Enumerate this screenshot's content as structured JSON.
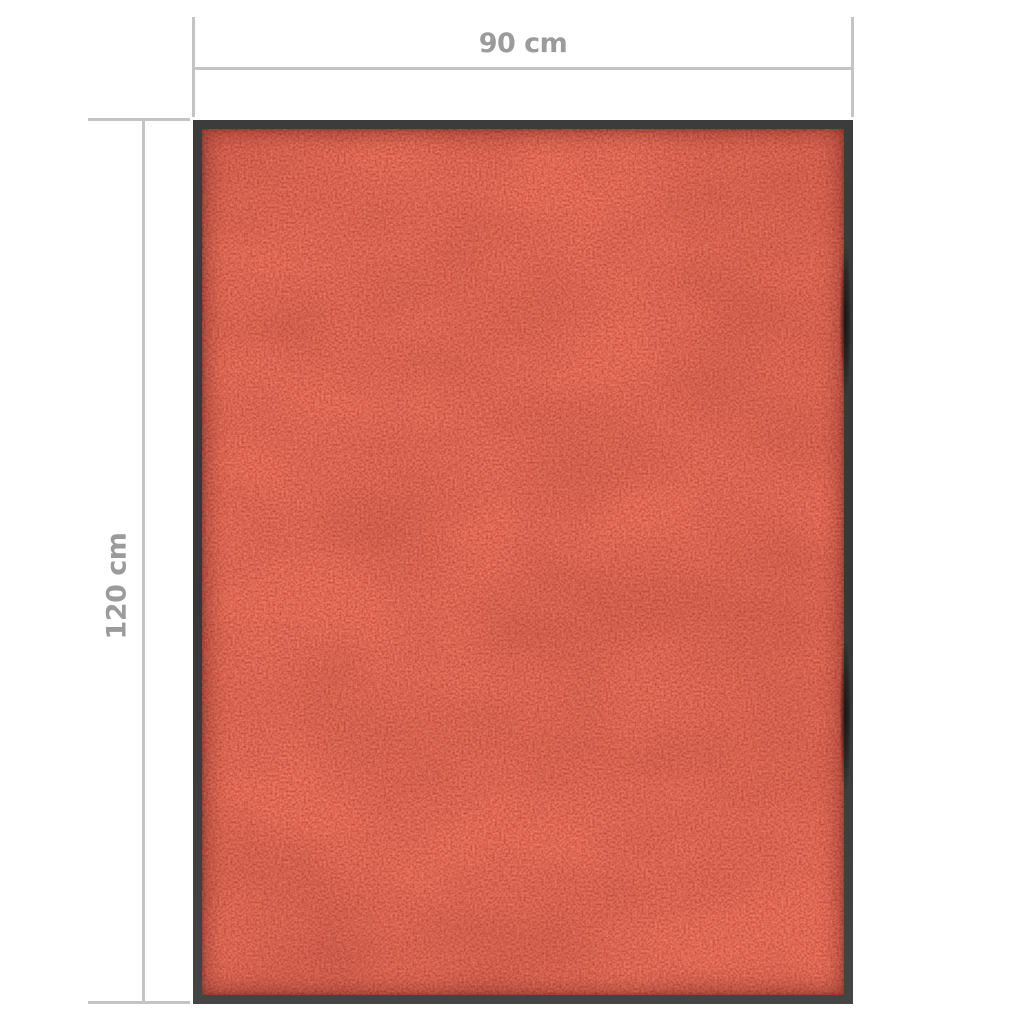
{
  "dimensions": {
    "width_label": "90 cm",
    "height_label": "120 cm"
  },
  "colors": {
    "background": "#ffffff",
    "dimension_line": "#c4c4c4",
    "dimension_label": "#9b9b9b",
    "mat_border": "#3c3c3c",
    "mat_pile": "#c11b10",
    "mat_pile_dark": "#8d120c",
    "mat_pile_bright": "#e2452c"
  }
}
